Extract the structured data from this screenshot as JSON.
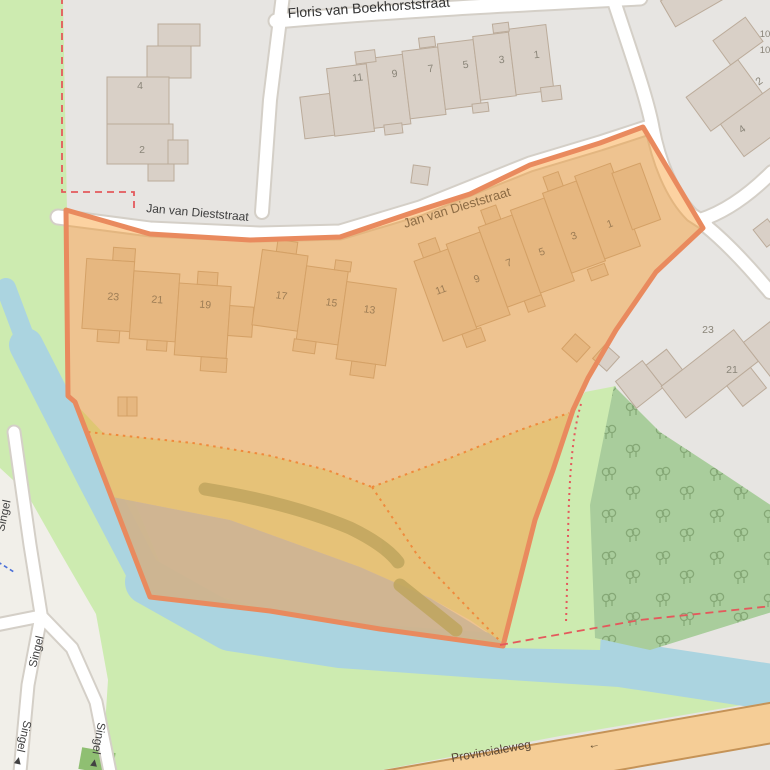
{
  "map": {
    "streets": {
      "floris": "Floris van Boekhorststraat",
      "jan_west": "Jan van Dieststraat",
      "jan_east": "Jan van Dieststraat",
      "singel": "Singel",
      "singel_with_arrow": "Singel ◄",
      "provincialeweg": "Provincialeweg",
      "oneway_arrow": "←"
    },
    "house_numbers": {
      "top_row": [
        "11",
        "9",
        "7",
        "5",
        "3",
        "1"
      ],
      "left_block": [
        "4",
        "2"
      ],
      "overlay_west_row": [
        "23",
        "21",
        "19"
      ],
      "overlay_mid_row": [
        "17",
        "15",
        "13"
      ],
      "overlay_east_row": [
        "11",
        "9",
        "7",
        "5",
        "3",
        "1"
      ],
      "east_block": [
        "23",
        "21"
      ],
      "ne_block": [
        "2",
        "4"
      ],
      "ne_edge": [
        "10",
        "10"
      ]
    },
    "colors": {
      "water": "#abd4e0",
      "grass": "#cdebb0",
      "forest": "#a9cd9c",
      "tree": "#7c9f6d",
      "residential": "#e7e5e2",
      "residential_light": "#f1efe9",
      "building": "#d9d0c7",
      "building_stroke": "#bbab9a",
      "road_fill": "#ffffff",
      "road_casing": "#d4cfc7",
      "primary_fill": "#f5cd96",
      "primary_casing": "#c59357",
      "overlay_fill": "#f8941e",
      "overlay_stroke": "#e98a5e",
      "boundary": "#e4595c",
      "boundary_blue": "#4a6fd8",
      "farmland": "#e6c278",
      "scrub": "#cdb493",
      "track": "#bfa55e",
      "dark_green_patch": "#8fbf72"
    }
  }
}
